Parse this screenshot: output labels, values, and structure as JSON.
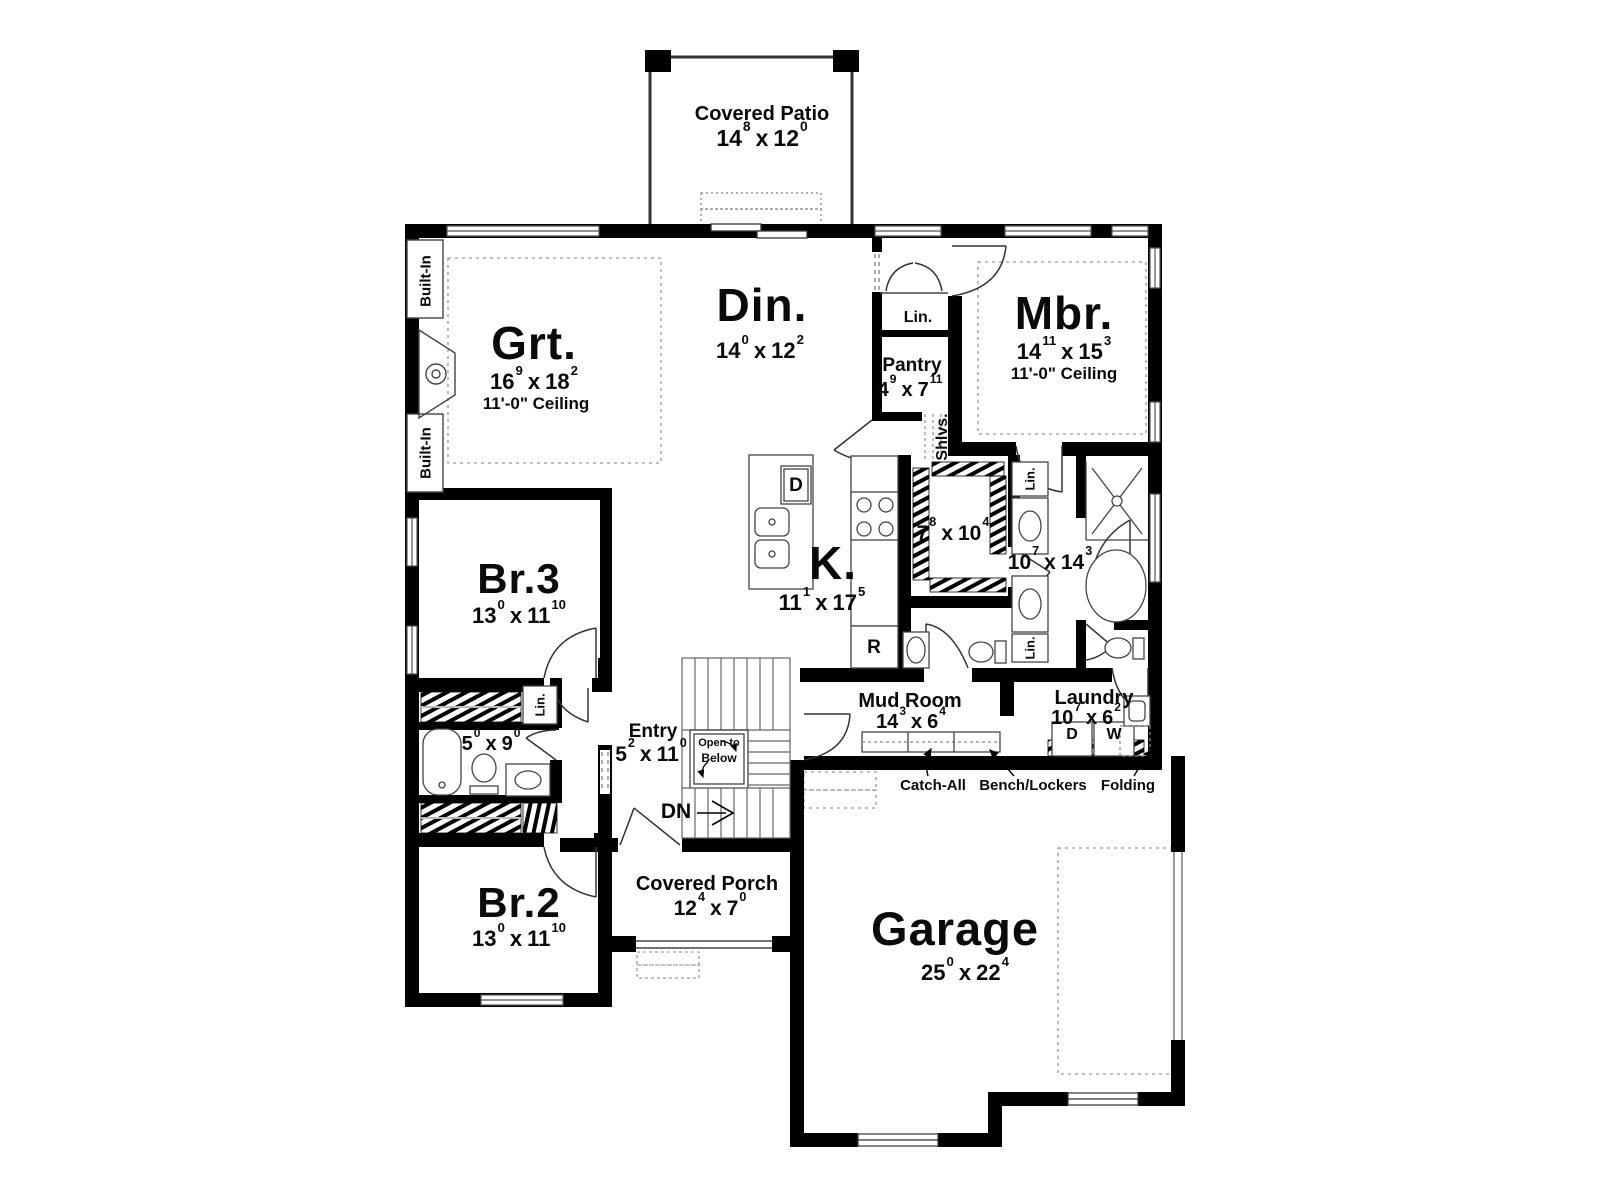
{
  "plan": {
    "rooms": {
      "covered_patio": {
        "name": "Covered Patio",
        "dim": {
          "f1": "14",
          "i1": "8",
          "x": "x",
          "f2": "12",
          "i2": "0"
        }
      },
      "great_room": {
        "name": "Grt.",
        "dim": {
          "f1": "16",
          "i1": "9",
          "x": "x",
          "f2": "18",
          "i2": "2"
        },
        "ceiling": "11'-0\" Ceiling"
      },
      "dining": {
        "name": "Din.",
        "dim": {
          "f1": "14",
          "i1": "0",
          "x": "x",
          "f2": "12",
          "i2": "2"
        }
      },
      "master_bedroom": {
        "name": "Mbr.",
        "dim": {
          "f1": "14",
          "i1": "11",
          "x": "x",
          "f2": "15",
          "i2": "3"
        },
        "ceiling": "11'-0\" Ceiling"
      },
      "pantry": {
        "name": "Pantry",
        "dim": {
          "f1": "4",
          "i1": "9",
          "x": "x",
          "f2": "7",
          "i2": "11"
        }
      },
      "kitchen": {
        "name": "K.",
        "dim": {
          "f1": "11",
          "i1": "1",
          "x": "x",
          "f2": "17",
          "i2": "5"
        }
      },
      "master_closet": {
        "dim": {
          "f1": "7",
          "i1": "8",
          "x": "x",
          "f2": "10",
          "i2": "4"
        }
      },
      "master_bath": {
        "dim": {
          "f1": "10",
          "i1": "7",
          "x": "x",
          "f2": "14",
          "i2": "3"
        }
      },
      "bedroom_3": {
        "name": "Br.3",
        "dim": {
          "f1": "13",
          "i1": "0",
          "x": "x",
          "f2": "11",
          "i2": "10"
        }
      },
      "hall_bath": {
        "dim": {
          "f1": "5",
          "i1": "0",
          "x": "x",
          "f2": "9",
          "i2": "0"
        }
      },
      "entry": {
        "name": "Entry",
        "dim": {
          "f1": "5",
          "i1": "2",
          "x": "x",
          "f2": "11",
          "i2": "0"
        }
      },
      "mud_room": {
        "name": "Mud Room",
        "dim": {
          "f1": "14",
          "i1": "3",
          "x": "x",
          "f2": "6",
          "i2": "4"
        }
      },
      "laundry": {
        "name": "Laundry",
        "dim": {
          "f1": "10",
          "i1": "7",
          "x": "x",
          "f2": "6",
          "i2": "2"
        }
      },
      "bedroom_2": {
        "name": "Br.2",
        "dim": {
          "f1": "13",
          "i1": "0",
          "x": "x",
          "f2": "11",
          "i2": "10"
        }
      },
      "covered_porch": {
        "name": "Covered Porch",
        "dim": {
          "f1": "12",
          "i1": "4",
          "x": "x",
          "f2": "7",
          "i2": "0"
        }
      },
      "garage": {
        "name": "Garage",
        "dim": {
          "f1": "25",
          "i1": "0",
          "x": "x",
          "f2": "22",
          "i2": "4"
        }
      }
    },
    "annotations": {
      "linen": "Lin.",
      "shelves": "Shlvs.",
      "built_in": "Built-In",
      "open_to_below_line1": "Open to",
      "open_to_below_line2": "Below",
      "down": "DN",
      "catch_all": "Catch-All",
      "bench_lockers": "Bench/Lockers",
      "folding": "Folding"
    },
    "appliances": {
      "dishwasher": "D",
      "refrigerator": "R",
      "dryer": "D",
      "washer": "W"
    },
    "colors": {
      "wall": "#000000",
      "thin_line": "#444444",
      "dashed_line": "#888888",
      "background": "#ffffff"
    }
  }
}
